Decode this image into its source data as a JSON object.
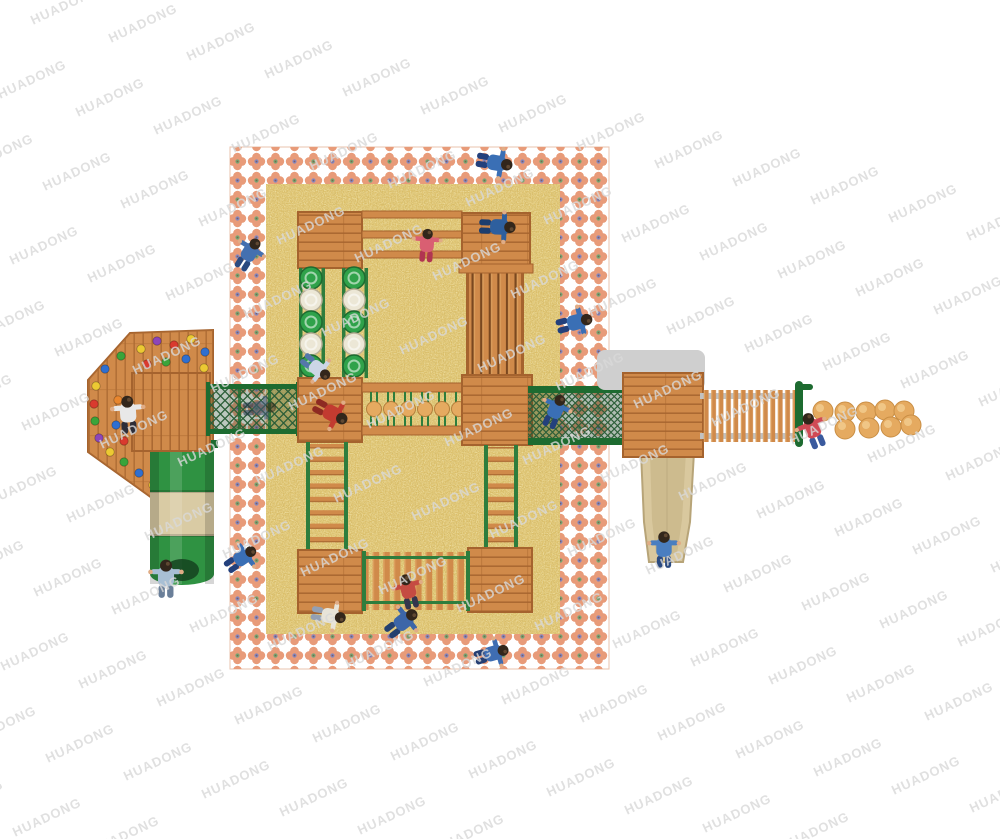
{
  "watermark": {
    "text": "HUADONG",
    "angle_deg": -25,
    "font_size_px": 13,
    "opacity": 0.8,
    "color": "#d9d9d9",
    "grid": {
      "v1": [
        78,
        18
      ],
      "v2": [
        45,
        92
      ],
      "origin": [
        -50,
        -4
      ],
      "i_range": [
        -6,
        14
      ],
      "j_range": [
        0,
        10
      ]
    }
  },
  "colors": {
    "background": "#ffffff",
    "watermark": "#d9d9d9",
    "sand": "#dfc26b",
    "petal": "#e89b79",
    "petal_green": "#74a874",
    "petal_blue": "#8287c2",
    "wood": "#d08a4a",
    "wood_dark": "#a5632e",
    "wood_deep": "#7a4820",
    "wood_light": "#e8b470",
    "green": "#2f9242",
    "green_dark": "#1d6b30",
    "rope": "#2e7d3d",
    "mesh": "#2c5e38",
    "disc_white": "#ece7d6",
    "disc_green": "#2fa24a",
    "slide_beige": "#d9c89e",
    "tube_beige": "#d9cba4",
    "gray_mat": "#cfcfcf",
    "gray_rail": "#c2c2c2",
    "ball": "#e5aa60",
    "skin": "#e0ac85",
    "hair": "#32261b"
  },
  "playground": {
    "disc_climber": {
      "columns": [
        311,
        354
      ],
      "radius": 11,
      "rows": [
        {
          "y": 278,
          "color": "green"
        },
        {
          "y": 300,
          "color": "white"
        },
        {
          "y": 322,
          "color": "green"
        },
        {
          "y": 344,
          "color": "white"
        },
        {
          "y": 366,
          "color": "green"
        }
      ]
    },
    "rope_ball_run": {
      "cy": 409,
      "r": 7.5,
      "rope_top_y": 392,
      "rope_bottom_y": 426,
      "cx": [
        374,
        391,
        408,
        425,
        442,
        459
      ]
    },
    "stepping_balls": {
      "r": 10,
      "positions": [
        [
          823,
          411
        ],
        [
          845,
          412
        ],
        [
          866,
          412
        ],
        [
          885,
          410
        ],
        [
          904,
          411
        ],
        [
          845,
          429
        ],
        [
          869,
          428
        ],
        [
          891,
          427
        ],
        [
          911,
          425
        ]
      ]
    },
    "climb_holds": [
      [
        141,
        349,
        "#ecc933"
      ],
      [
        157,
        341,
        "#8d46b8"
      ],
      [
        174,
        345,
        "#d93a2e"
      ],
      [
        191,
        339,
        "#ecc933"
      ],
      [
        205,
        352,
        "#2f6fd0"
      ],
      [
        147,
        364,
        "#d93a2e"
      ],
      [
        166,
        362,
        "#3aa43a"
      ],
      [
        186,
        359,
        "#2f6fd0"
      ],
      [
        204,
        368,
        "#ecc933"
      ],
      [
        121,
        356,
        "#3aa43a"
      ],
      [
        105,
        369,
        "#2f6fd0"
      ],
      [
        96,
        386,
        "#ecc933"
      ],
      [
        94,
        404,
        "#d93a2e"
      ],
      [
        95,
        421,
        "#3aa43a"
      ],
      [
        99,
        438,
        "#8d46b8"
      ],
      [
        110,
        452,
        "#ecc933"
      ],
      [
        118,
        400,
        "#e8862e"
      ],
      [
        116,
        425,
        "#2f6fd0"
      ],
      [
        124,
        462,
        "#3aa43a"
      ],
      [
        139,
        473,
        "#2f6fd0"
      ],
      [
        153,
        485,
        "#ecc933"
      ],
      [
        170,
        478,
        "#d93a2e"
      ],
      [
        186,
        468,
        "#3aa43a"
      ],
      [
        201,
        459,
        "#e8862e"
      ],
      [
        124,
        441,
        "#d93a2e"
      ]
    ],
    "children": [
      {
        "x": 497,
        "y": 163,
        "rot": 100,
        "scale": 1.1,
        "shirt": "#3a6fb5",
        "pants": "#23407c"
      },
      {
        "x": 500,
        "y": 227,
        "rot": 92,
        "scale": 1.1,
        "shirt": "#2e5f9e",
        "pants": "#1d3e6e"
      },
      {
        "x": 250,
        "y": 252,
        "rot": 32,
        "scale": 1.05,
        "shirt": "#4470b0",
        "pants": "#2a4a80"
      },
      {
        "x": 427,
        "y": 243,
        "rot": 4,
        "scale": 1.0,
        "shirt": "#d95f72",
        "pants": "#b13551"
      },
      {
        "x": 577,
        "y": 322,
        "rot": 76,
        "scale": 1.1,
        "shirt": "#3a6fb5",
        "pants": "#23407c"
      },
      {
        "x": 318,
        "y": 369,
        "rot": 128,
        "scale": 1.0,
        "shirt": "#ccd6e6",
        "pants": "#5577aa"
      },
      {
        "x": 128,
        "y": 412,
        "rot": -4,
        "scale": 1.15,
        "shirt": "#e8e8e8",
        "pants": "#2e2e38"
      },
      {
        "x": 262,
        "y": 408,
        "rot": 86,
        "scale": 1.0,
        "shirt": "#44567a",
        "pants": "#22304a",
        "opacity": 0.55
      },
      {
        "x": 333,
        "y": 414,
        "rot": 118,
        "scale": 1.1,
        "shirt": "#c23b30",
        "pants": "#8e2a22"
      },
      {
        "x": 556,
        "y": 409,
        "rot": 24,
        "scale": 1.05,
        "shirt": "#3a6fb5",
        "pants": "#23407c"
      },
      {
        "x": 812,
        "y": 428,
        "rot": -22,
        "scale": 1.1,
        "shirt": "#d04a55",
        "pants": "#3a5a9e"
      },
      {
        "x": 664,
        "y": 547,
        "rot": 0,
        "scale": 1.1,
        "shirt": "#4a7ec0",
        "pants": "#2a4a80"
      },
      {
        "x": 243,
        "y": 557,
        "rot": 55,
        "scale": 1.05,
        "shirt": "#3a6fb5",
        "pants": "#23407c"
      },
      {
        "x": 166,
        "y": 576,
        "rot": 0,
        "scale": 1.15,
        "shirt": "#a8bfd4",
        "pants": "#6a7f99"
      },
      {
        "x": 331,
        "y": 616,
        "rot": 100,
        "scale": 1.05,
        "shirt": "#e8e4d8",
        "pants": "#93a0b4"
      },
      {
        "x": 404,
        "y": 621,
        "rot": 52,
        "scale": 1.1,
        "shirt": "#3c66a8",
        "pants": "#24406f"
      },
      {
        "x": 408,
        "y": 589,
        "rot": -14,
        "scale": 1.05,
        "shirt": "#c54b42",
        "pants": "#35354d"
      },
      {
        "x": 494,
        "y": 653,
        "rot": 74,
        "scale": 1.05,
        "shirt": "#3f6db2",
        "pants": "#263f73"
      }
    ]
  }
}
